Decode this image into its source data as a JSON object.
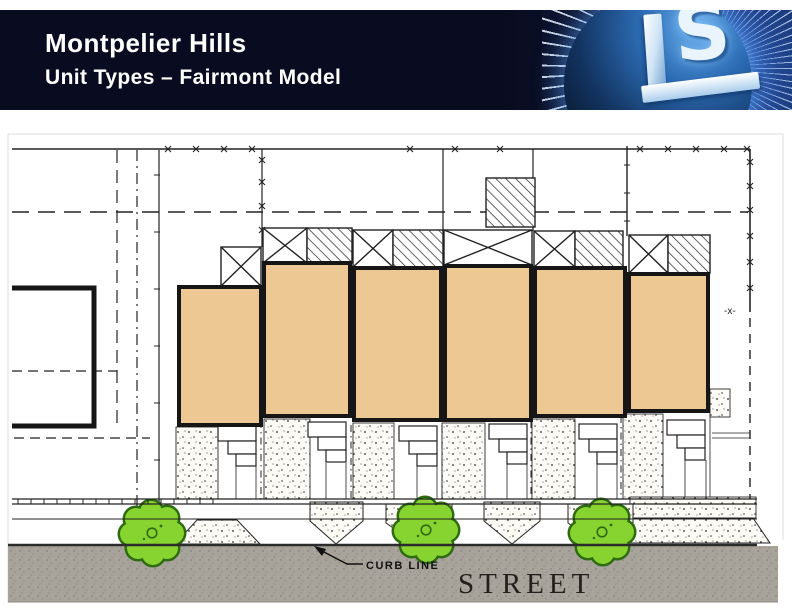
{
  "slide": {
    "title": "Montpelier Hills",
    "subtitle": "Unit Types – Fairmont Model"
  },
  "logo": {
    "name": "ls-starburst-logo",
    "letter_l": "L",
    "letter_s": "S"
  },
  "plan": {
    "street_label": "STREET",
    "curb_line_label": "CURB LINE",
    "boundary_marker": "-x-",
    "unit_count": 6,
    "tree_count": 3,
    "colors": {
      "unit_fill": "#edc892",
      "street": "#a8a39a",
      "tree_fill": "#87d32f",
      "tree_outline": "#2e6b10",
      "header_bg": "#090c20",
      "logo_blue": "#2c6cb4",
      "linework": "#222222"
    }
  }
}
